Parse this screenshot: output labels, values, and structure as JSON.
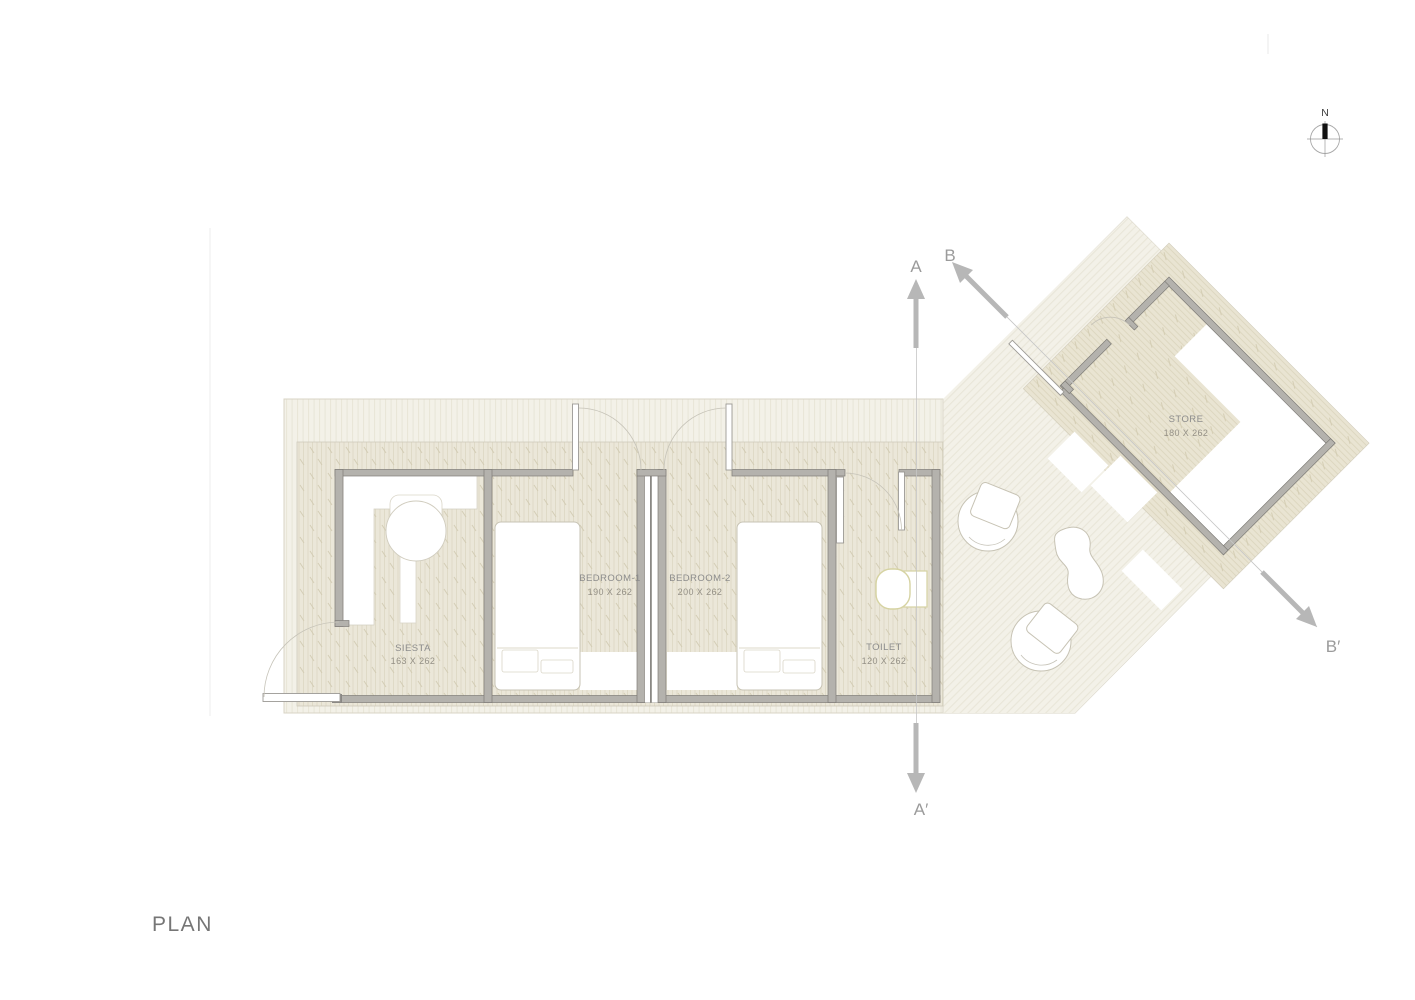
{
  "title": {
    "label": "PLAN"
  },
  "north": {
    "label": "N"
  },
  "sections": {
    "a_start": "A",
    "a_end": "A′",
    "b_start": "B",
    "b_end": "B′"
  },
  "rooms": [
    {
      "id": "siesta",
      "name": "SIESTA",
      "dimensions": "163 X 262"
    },
    {
      "id": "bedroom1",
      "name": "BEDROOM-1",
      "dimensions": "190 X 262"
    },
    {
      "id": "bedroom2",
      "name": "BEDROOM-2",
      "dimensions": "200 X 262"
    },
    {
      "id": "toilet",
      "name": "TOILET",
      "dimensions": "120 X 262"
    },
    {
      "id": "store",
      "name": "STORE",
      "dimensions": "180 X 262"
    }
  ],
  "colors": {
    "deck": "#f3f1e8",
    "floor": "#ebe7d9",
    "store_floor": "#e9e4d2",
    "wall": "#b4b2ad",
    "wall_stroke": "#7f7d78",
    "outline": "#d8d4c6",
    "label_text": "#8c8c8c",
    "section_gray": "#b7b7b7",
    "fixture_stroke": "#d6d3a2"
  }
}
